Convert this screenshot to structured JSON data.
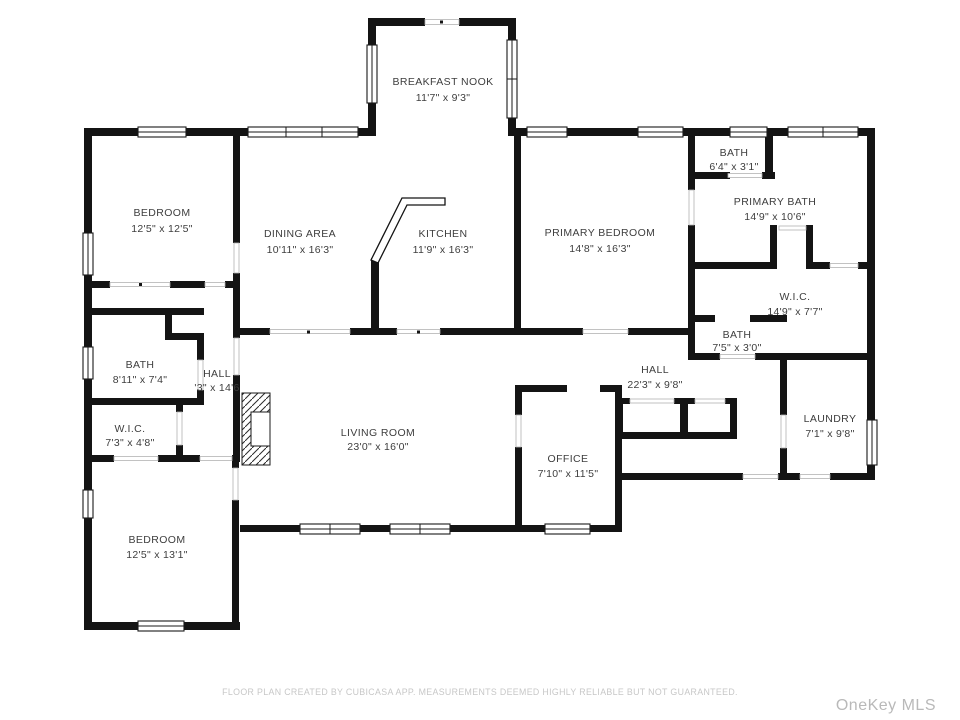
{
  "plan_title": "Floor plan",
  "colors": {
    "wall": "#141414",
    "label_text": "#3e3e3e",
    "disclaimer_text": "#c7c7c7",
    "watermark_text": "#b9b9b9",
    "background": "#ffffff"
  },
  "rooms": [
    {
      "id": "breakfast-nook",
      "name": "BREAKFAST NOOK",
      "dims": "11'7\" x 9'3\""
    },
    {
      "id": "bedroom-top-left",
      "name": "BEDROOM",
      "dims": "12'5\" x 12'5\""
    },
    {
      "id": "dining-area",
      "name": "DINING AREA",
      "dims": "10'11\" x 16'3\""
    },
    {
      "id": "kitchen",
      "name": "KITCHEN",
      "dims": "11'9\" x 16'3\""
    },
    {
      "id": "primary-bedroom",
      "name": "PRIMARY BEDROOM",
      "dims": "14'8\" x 16'3\""
    },
    {
      "id": "bath-top",
      "name": "BATH",
      "dims": "6'4\" x 3'1\""
    },
    {
      "id": "primary-bath",
      "name": "PRIMARY BATH",
      "dims": "14'9\" x 10'6\""
    },
    {
      "id": "wic-right",
      "name": "W.I.C.",
      "dims": "14'9\" x 7'7\""
    },
    {
      "id": "bath-mid-right",
      "name": "BATH",
      "dims": "7'5\" x 3'0\""
    },
    {
      "id": "hall-right",
      "name": "HALL",
      "dims": "22'3\" x 9'8\""
    },
    {
      "id": "laundry",
      "name": "LAUNDRY",
      "dims": "7'1\" x 9'8\""
    },
    {
      "id": "bath-left",
      "name": "BATH",
      "dims": "8'11\" x 7'4\""
    },
    {
      "id": "hall-left",
      "name": "HALL",
      "dims": "'3\" x 14'6"
    },
    {
      "id": "wic-left",
      "name": "W.I.C.",
      "dims": "7'3\" x 4'8\""
    },
    {
      "id": "living-room",
      "name": "LIVING ROOM",
      "dims": "23'0\" x 16'0\""
    },
    {
      "id": "office",
      "name": "OFFICE",
      "dims": "7'10\" x 11'5\""
    },
    {
      "id": "bedroom-bottom-left",
      "name": "BEDROOM",
      "dims": "12'5\" x 13'1\""
    }
  ],
  "footer": {
    "disclaimer": "FLOOR PLAN CREATED BY CUBICASA APP. MEASUREMENTS DEEMED HIGHLY RELIABLE BUT NOT GUARANTEED.",
    "watermark": "OneKey MLS"
  }
}
